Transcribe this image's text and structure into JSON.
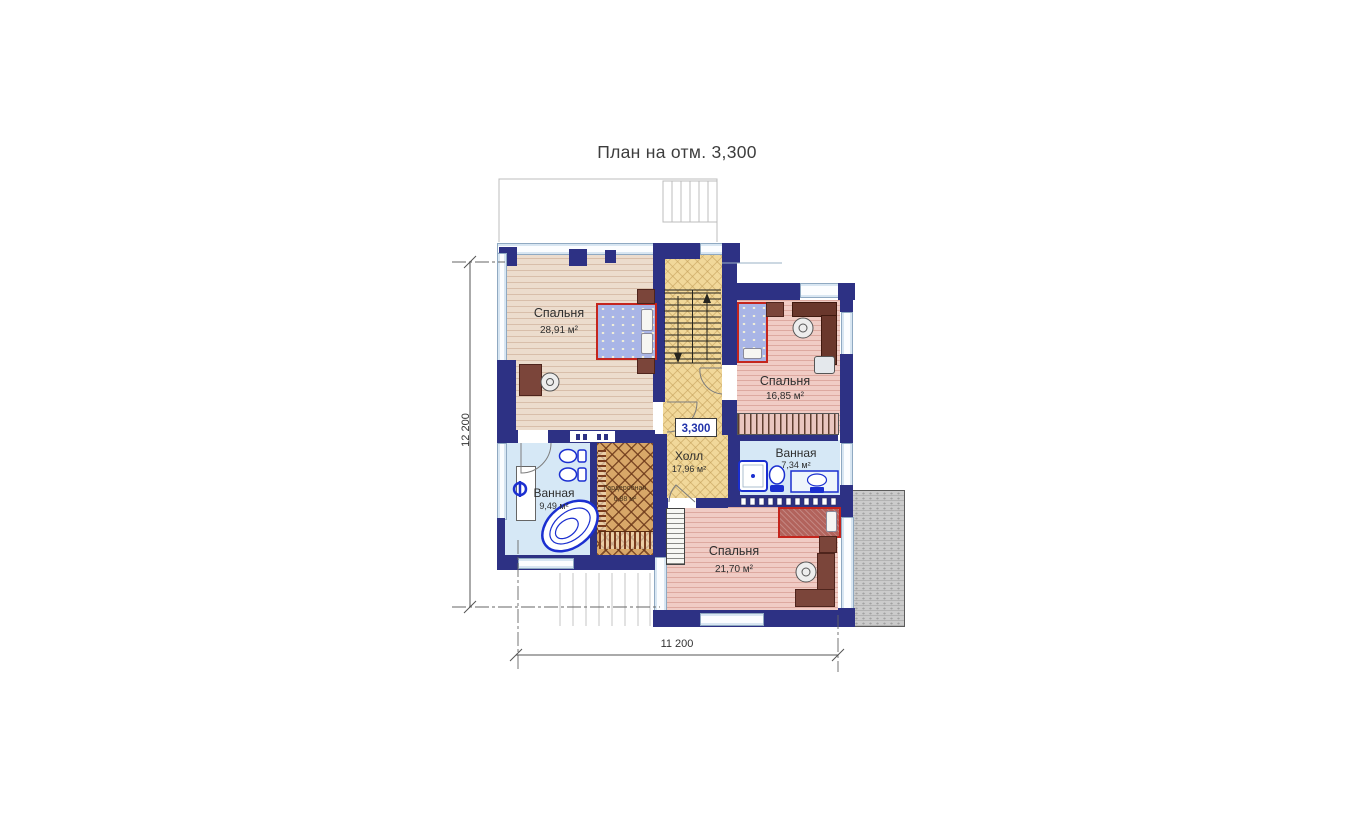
{
  "title": "План на отм. 3,300",
  "elevation_mark": "3,300",
  "dimensions": {
    "vertical": "12 200",
    "horizontal": "11 200"
  },
  "rooms": {
    "bedroom1": {
      "name": "Спальня",
      "area": "28,91 м²"
    },
    "bedroom2": {
      "name": "Спальня",
      "area": "16,85 м²"
    },
    "bedroom3": {
      "name": "Спальня",
      "area": "21,70 м²"
    },
    "bathroom1": {
      "name": "Ванная",
      "area": "9,49 м²"
    },
    "bathroom2": {
      "name": "Ванная",
      "area": "7,34 м²"
    },
    "hall": {
      "name": "Холл",
      "area": "17,96 м²"
    },
    "wardrobe": {
      "name": "Гардеробная",
      "area": "6,88 м²"
    }
  },
  "colors": {
    "wall": "#2d3184",
    "window": "#fbfdff",
    "hall_floor": "#f1d89a",
    "bedroom1_floor": "#ecdccd",
    "bedroom_pink_floor": "#f0ccc5",
    "bathroom_floor": "#d6e8f6",
    "wardrobe_floor": "#d8a768",
    "bed_outline": "#c4251d",
    "furniture_brown": "#7b453a",
    "terrace": "#cbcbcb",
    "fixture_blue": "#1b2fd0"
  }
}
